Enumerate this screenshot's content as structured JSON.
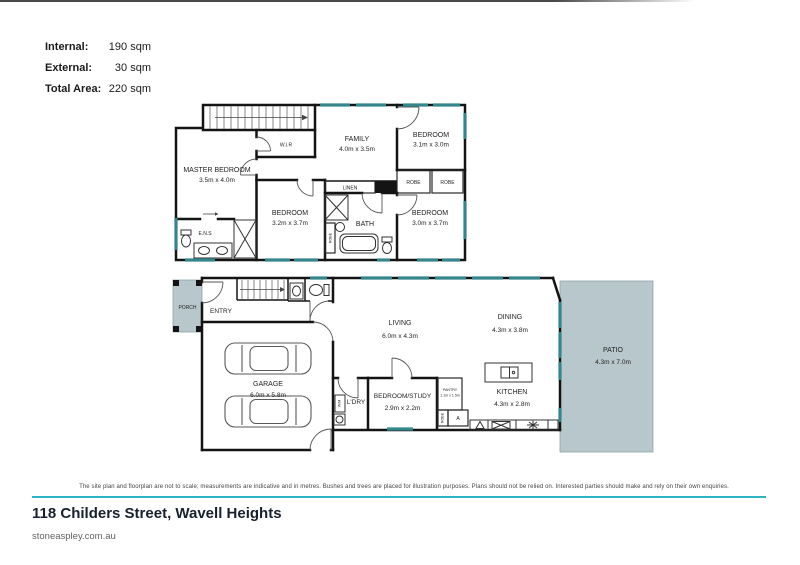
{
  "meta": {
    "address": "118 Childers Street, Wavell Heights",
    "website": "stoneaspley.com.au",
    "disclaimer": "The site plan and floorplan are not to scale; measurements are indicative and in metres. Bushes and trees are placed for illustration purposes. Plans should not be relied on. Interested parties should make and rely on their own enquiries."
  },
  "area_summary": {
    "internal": {
      "label": "Internal:",
      "value": "190 sqm"
    },
    "external": {
      "label": "External:",
      "value": "30 sqm"
    },
    "total": {
      "label": "Total Area:",
      "value": "220 sqm"
    }
  },
  "colors": {
    "wall": "#141414",
    "window_teal": "#35868c",
    "patio_fill": "#b8c7cb",
    "divider_teal": "#2cb3c4",
    "title_text": "#17222e"
  },
  "upper_floor": {
    "master_bedroom": {
      "name": "MASTER BEDROOM",
      "dims": "3.5m x 4.0m"
    },
    "wir": "W.I.R",
    "family": {
      "name": "FAMILY",
      "dims": "4.0m x 3.5m"
    },
    "bedroom_top_right": {
      "name": "BEDROOM",
      "dims": "3.1m x 3.0m"
    },
    "bedroom_middle": {
      "name": "BEDROOM",
      "dims": "3.2m x 3.7m"
    },
    "bedroom_bottom_right": {
      "name": "BEDROOM",
      "dims": "3.0m x 3.7m"
    },
    "bath": "BATH",
    "ens": "E.N.S",
    "linen": "LINEN",
    "robe_a": "ROBE",
    "robe_b": "ROBE",
    "robe_c": "ROBE"
  },
  "ground_floor": {
    "porch": "PORCH",
    "entry": "ENTRY",
    "garage": {
      "name": "GARAGE",
      "dims": "6.0m x 5.8m"
    },
    "living": {
      "name": "LIVING",
      "dims": "6.0m x 4.3m"
    },
    "dining": {
      "name": "DINING",
      "dims": "4.3m x 3.8m"
    },
    "kitchen": {
      "name": "KITCHEN",
      "dims": "4.3m x 2.8m"
    },
    "patio": {
      "name": "PATIO",
      "dims": "4.3m x 7.0m"
    },
    "bedroom_study": {
      "name": "BEDROOM/STUDY",
      "dims": "2.9m x 2.2m"
    },
    "pantry": {
      "name": "PANTRY",
      "dims": "1.1m x 1.5m"
    },
    "laundry": "L'DRY",
    "washing_machine": "W/M",
    "robe": "ROBE",
    "appliance_cupboard": "A"
  }
}
